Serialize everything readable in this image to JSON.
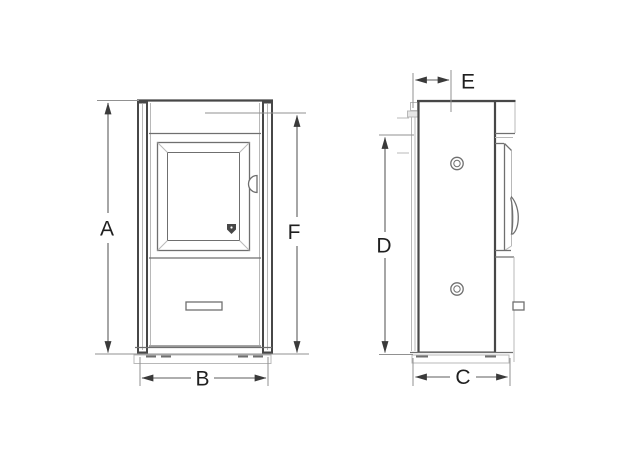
{
  "colors": {
    "bg": "#ffffff",
    "line": "#6f6f6f",
    "line-strong": "#474747",
    "line-faint": "#b8b8b8",
    "dim-line": "#5c5c5c",
    "ext-line": "#919191",
    "arrow": "#3a3a3a",
    "label": "#1f1f1f"
  },
  "dimensions": {
    "A": "A",
    "B": "B",
    "C": "C",
    "D": "D",
    "E": "E",
    "F": "F"
  }
}
